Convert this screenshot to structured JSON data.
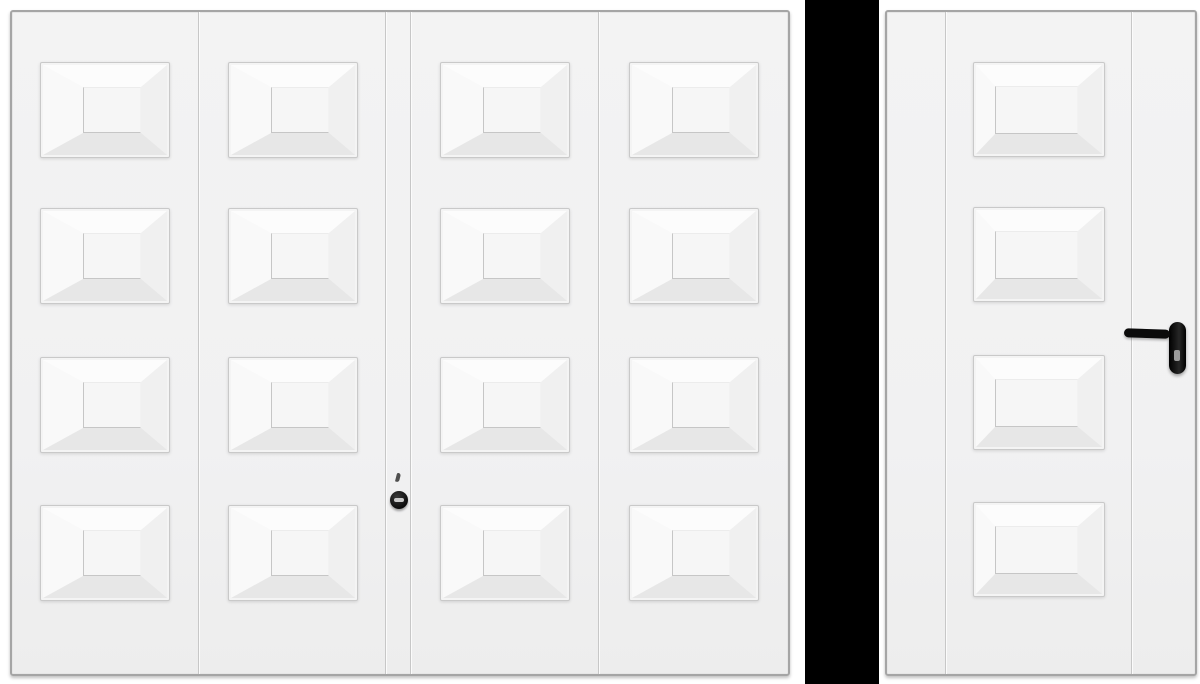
{
  "scene": {
    "type": "product-image",
    "items": [
      "garage-door",
      "side-door"
    ],
    "background_color": "#ffffff",
    "divider_color": "#000000"
  },
  "garage_door": {
    "label": "garage-door",
    "panel_columns": 4,
    "panel_rows": 4,
    "panel_total": 16,
    "rows": 4,
    "hardware": {
      "type": "round-lock-handle",
      "parts": [
        "keyhole-mark",
        "round-handle",
        "handle-slot"
      ],
      "color": "#0b0b0b"
    }
  },
  "side_door": {
    "label": "side-door",
    "panel_columns": 1,
    "panel_rows": 4,
    "panel_total": 4,
    "rows": 4,
    "hardware": {
      "type": "lever-handle",
      "parts": [
        "lever",
        "backplate",
        "keyhole"
      ],
      "color": "#0b0b0b"
    }
  },
  "colors": {
    "background": "#ffffff",
    "divider": "#000000",
    "door_face": "#f1f1f2",
    "door_border": "#a5a5a5",
    "seam_dark": "#c7c7c7",
    "seam_light": "#fbfbfb",
    "panel_border": "#c9c9c9",
    "bevel_top": "#fcfcfc",
    "bevel_right": "#f0f0f0",
    "bevel_bottom": "#e7e7e7",
    "bevel_left": "#f9f9f9",
    "panel_inner": "#f6f6f6",
    "inner_shadow": "#c6c6c6",
    "hardware_black": "#0b0b0b",
    "keyhole_gray": "#9b9b9b"
  }
}
